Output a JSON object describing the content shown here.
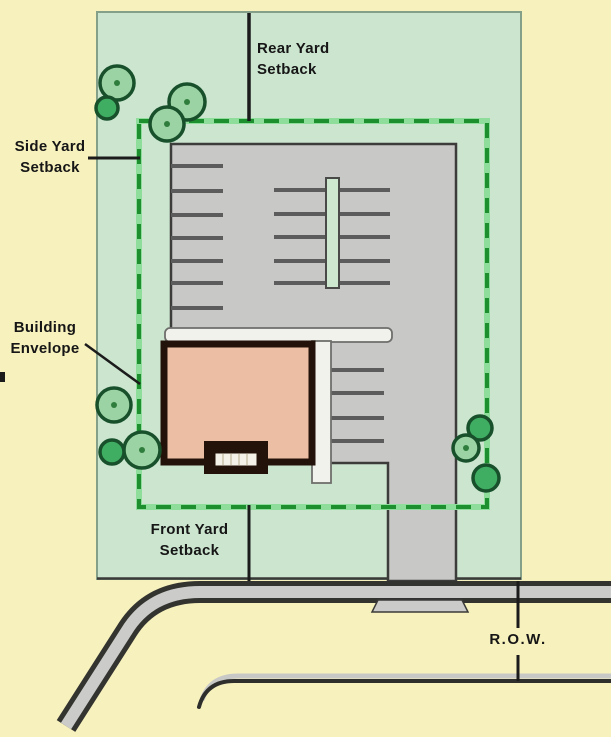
{
  "labels": {
    "rear_yard": {
      "line1": "Rear Yard",
      "line2": "Setback"
    },
    "side_yard": {
      "line1": "Side Yard",
      "line2": "Setback"
    },
    "building_envelope": {
      "line1": "Building",
      "line2": "Envelope"
    },
    "front_yard": {
      "line1": "Front Yard",
      "line2": "Setback"
    },
    "right_of_way": {
      "text": "R.O.W."
    }
  },
  "colors": {
    "background": "#F7F1BD",
    "lot_green": "#CBE5CF",
    "envelope_dash": "#1E8F2E",
    "envelope_dash_halo": "#8FDD9B",
    "pavement": "#C8C8C6",
    "stripe": "#5C5C5C",
    "building_fill": "#ECBFA4",
    "building_outline": "#231209",
    "walkway": "#F2F2EC",
    "tree_light": "#9CD3A4",
    "tree_dark": "#3FAE63",
    "tree_outline": "#17502A",
    "road_dark": "#33332F",
    "road_gray": "#CBCBC9",
    "label_text": "#161616"
  }
}
